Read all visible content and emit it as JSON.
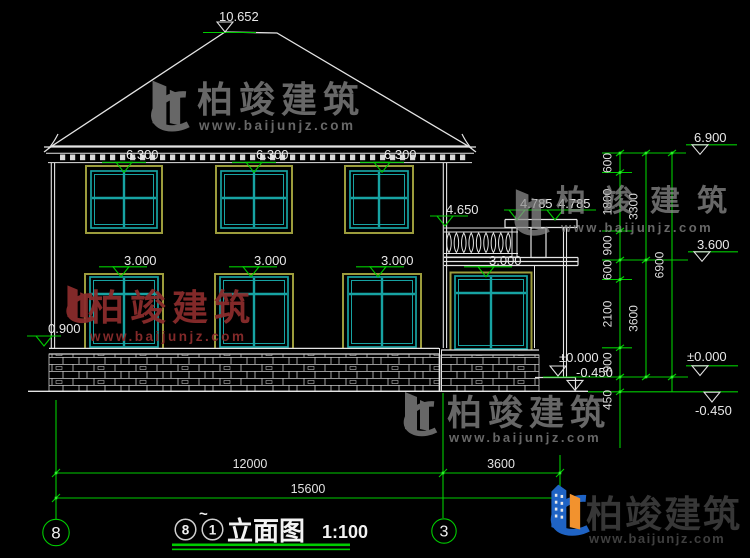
{
  "drawing": {
    "ridge_mark": "10.652",
    "eave_marks": [
      "6.300",
      "6.300",
      "6.300"
    ],
    "floor_marks": [
      "3.000",
      "3.000",
      "3.000",
      "3.000"
    ],
    "balcony_mark": "4.650",
    "porch_marks": [
      "4.785",
      "4.785"
    ],
    "sill_mark": "0.900",
    "ground_zero": "±0.000",
    "ground_minus": "-0.450",
    "right_levels": {
      "top": "6.900",
      "mid": "3.600",
      "zero": "±0.000",
      "minus": "-0.450"
    },
    "vchain": {
      "segs": [
        "600",
        "1800",
        "900",
        "600",
        "2100",
        "900",
        "450"
      ],
      "sub": [
        "3300",
        "3600"
      ],
      "total": "6900"
    },
    "hdims": {
      "left": "12000",
      "right": "3600",
      "total": "15600"
    },
    "axes": {
      "left": "8",
      "mid": "3"
    }
  },
  "title_block": {
    "from": "8",
    "tilde": "~",
    "to": "1",
    "name": "立面图",
    "scale": "1:100"
  },
  "watermark": {
    "brand": "柏竣建筑",
    "url": "www.baijunjz.com"
  }
}
